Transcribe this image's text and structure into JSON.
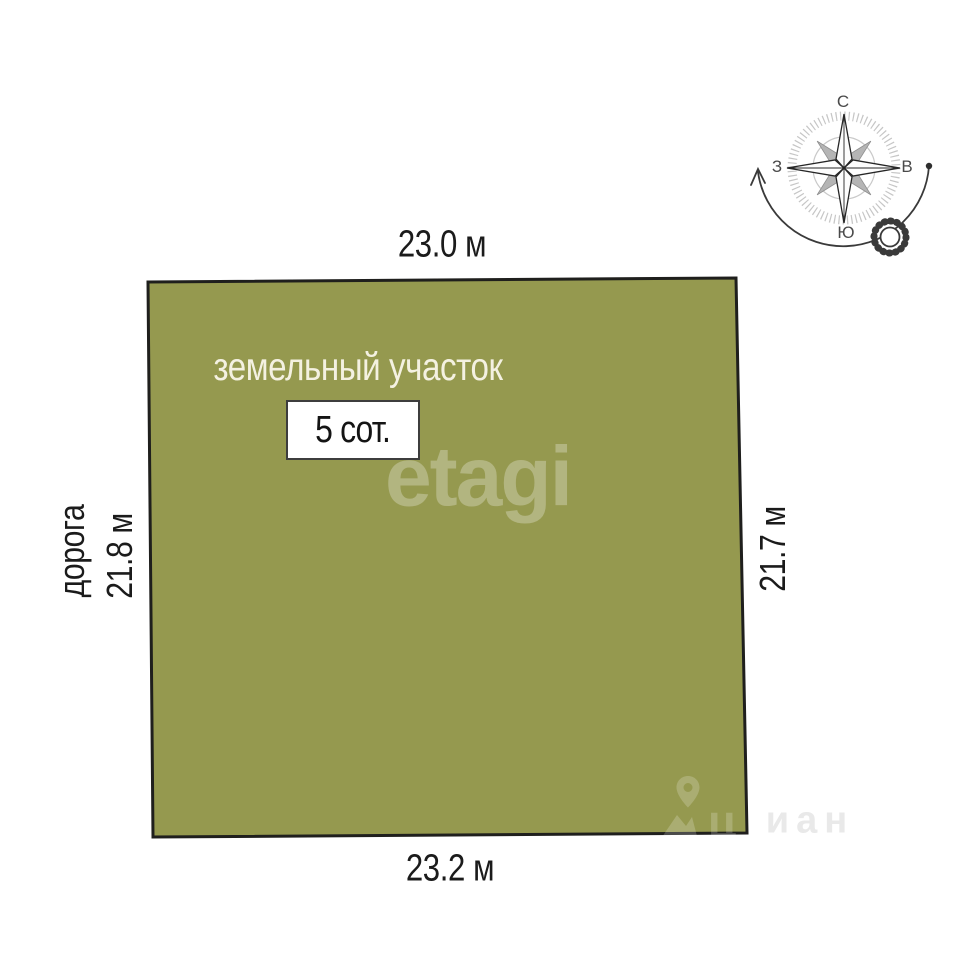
{
  "plot": {
    "label": "земельный участок",
    "area_label": "5 сот.",
    "fill_color": "#95994f",
    "border_color": "#1f1f1d"
  },
  "dimensions": {
    "top": "23.0 м",
    "bottom": "23.2 м",
    "left": "21.8 м",
    "right": "21.7 м"
  },
  "road_label": "дорога",
  "compass": {
    "north": "С",
    "south": "Ю",
    "west": "З",
    "east": "В"
  },
  "watermarks": {
    "center": "etagi",
    "corner_on_plot": "ц",
    "corner_on_white": "иан"
  }
}
